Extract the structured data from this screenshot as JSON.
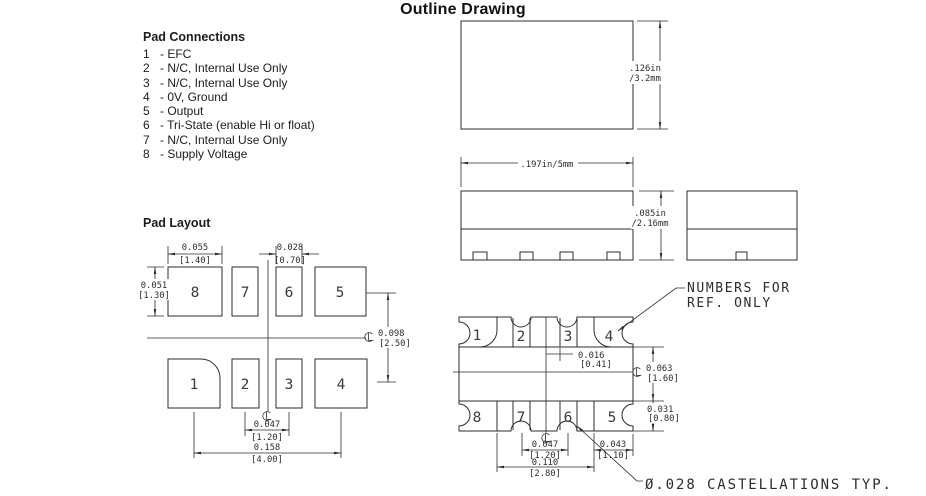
{
  "colors": {
    "ink": "#2c2c2c",
    "background": "#ffffff"
  },
  "title": "Outline Drawing",
  "pad_connections": {
    "heading": "Pad Connections",
    "items": [
      {
        "num": "1",
        "desc": "- EFC"
      },
      {
        "num": "2",
        "desc": "- N/C, Internal Use Only"
      },
      {
        "num": "3",
        "desc": "- N/C, Internal Use Only"
      },
      {
        "num": "4",
        "desc": "- 0V, Ground"
      },
      {
        "num": "5",
        "desc": "- Output"
      },
      {
        "num": "6",
        "desc": "- Tri-State (enable Hi or float)"
      },
      {
        "num": "7",
        "desc": "- N/C, Internal Use Only"
      },
      {
        "num": "8",
        "desc": "- Supply Voltage"
      }
    ]
  },
  "pad_layout": {
    "heading": "Pad Layout",
    "top_row": [
      "8",
      "7",
      "6",
      "5"
    ],
    "bottom_row": [
      "1",
      "2",
      "3",
      "4"
    ],
    "dims": {
      "corner_pad_width": {
        "in": "0.055",
        "mm": "[1.40]"
      },
      "center_pad_width": {
        "in": "0.028",
        "mm": "[0.70]"
      },
      "pad_height": {
        "in": "0.051",
        "mm": "[1.30]"
      },
      "row_offset": {
        "in": "0.098",
        "mm": "[2.50]"
      },
      "center_pitch": {
        "in": "0.047",
        "mm": "[1.20]"
      },
      "corner_pitch": {
        "in": "0.158",
        "mm": "[4.00]"
      }
    }
  },
  "package_views": {
    "top_view_height": {
      "line1": ".126in",
      "line2": "/3.2mm"
    },
    "front_view_width": ".197in/5mm",
    "front_view_height": {
      "line1": ".085in",
      "line2": "/2.16mm"
    }
  },
  "bottom_view": {
    "top_row": [
      "1",
      "2",
      "3",
      "4"
    ],
    "bottom_row": [
      "8",
      "7",
      "6",
      "5"
    ],
    "dims": {
      "pad_offset": {
        "in": "0.016",
        "mm": "[0.41]"
      },
      "row_gap": {
        "in": "0.063",
        "mm": "[1.60]"
      },
      "pad_height": {
        "in": "0.031",
        "mm": "[0.80]"
      },
      "edge_pad_pitch": {
        "in": "0.043",
        "mm": "[1.10]"
      },
      "center_pad_pitch": {
        "in": "0.047",
        "mm": "[1.20]"
      },
      "pad_span": {
        "in": "0.110",
        "mm": "[2.80]"
      }
    },
    "callouts": {
      "numbers_ref_line1": "NUMBERS FOR",
      "numbers_ref_line2": "REF. ONLY",
      "castellations": "Ø.028 CASTELLATIONS TYP."
    }
  }
}
